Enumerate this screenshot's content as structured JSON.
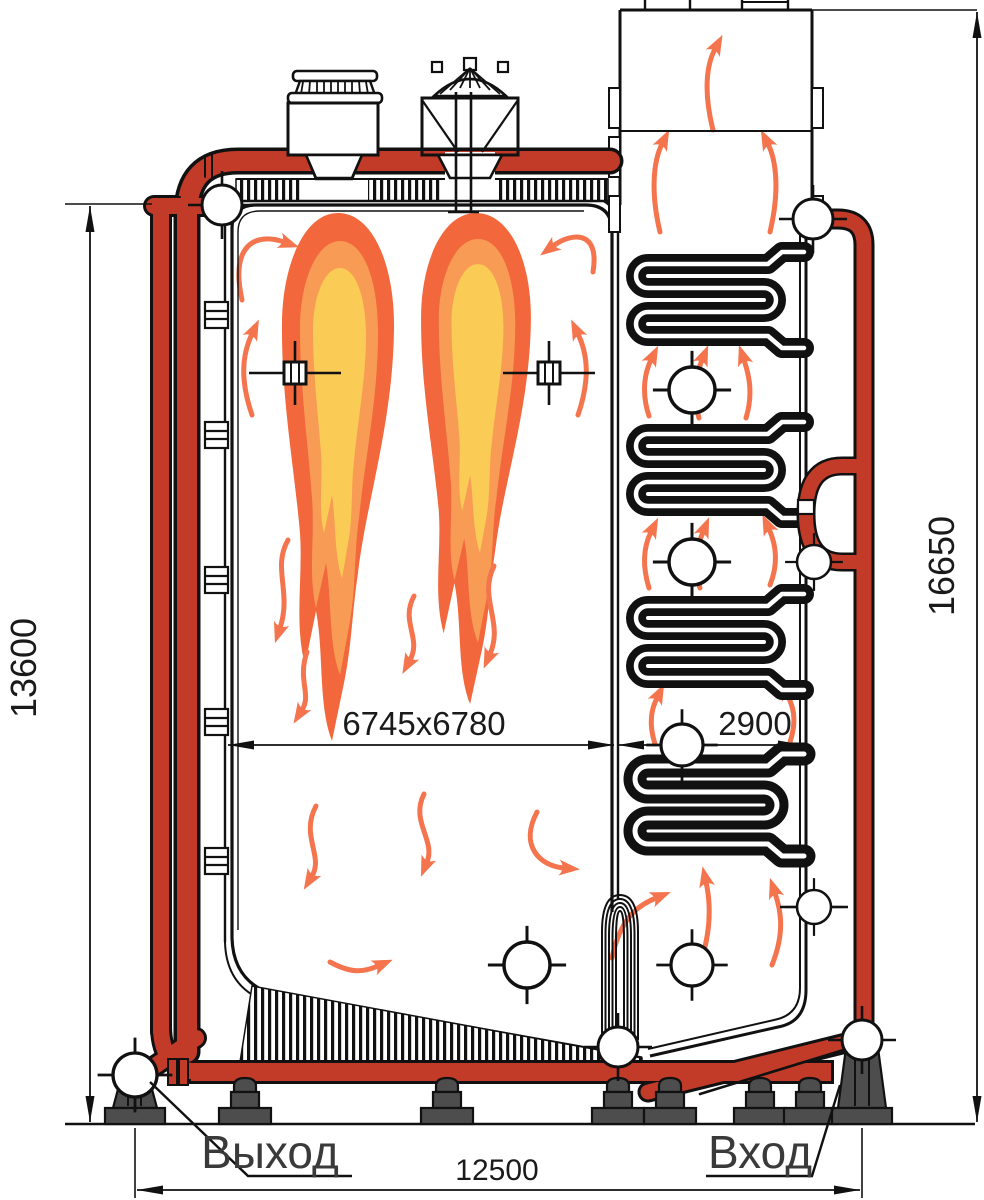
{
  "drawing": {
    "type": "boiler-sectional-drawing",
    "labels": {
      "outlet": "Выход",
      "inlet": "Вход"
    },
    "dimensions": {
      "furnace_height": "13600",
      "total_height": "16650",
      "furnace_size": "6745x6780",
      "shaft_width": "2900",
      "total_width": "12500"
    },
    "colors": {
      "pipe_red": "#c23b28",
      "flame_outer": "#f2683c",
      "flame_mid": "#f89c55",
      "flame_inner": "#fbcc55",
      "arrow": "#f4744e",
      "support_gray": "#4d4d4d",
      "line": "#111111"
    }
  }
}
